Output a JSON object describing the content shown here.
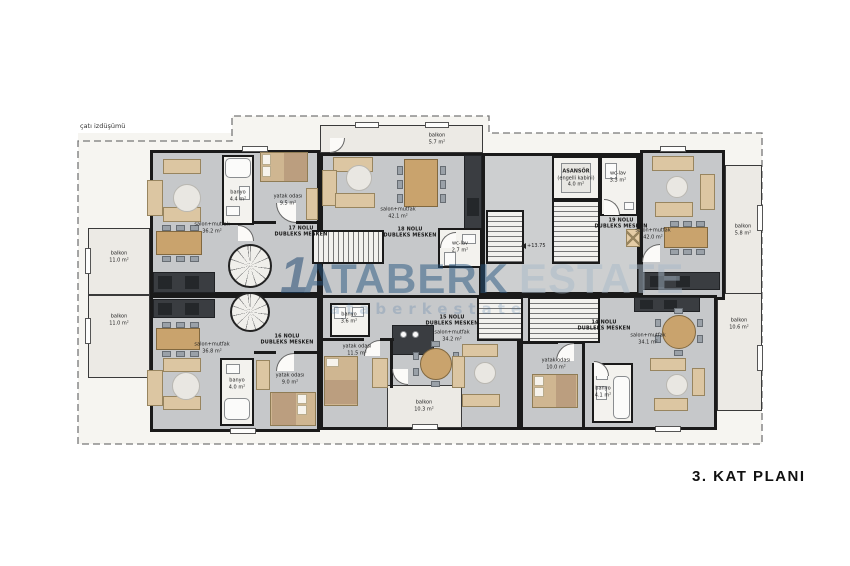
{
  "title": "3. KAT PLANI",
  "annotations": {
    "roof_projection": "çatı izdüşümü",
    "elevation": "+13.75"
  },
  "watermark": {
    "logo": "1",
    "brand": "ATABERK",
    "suffix": "ESTATE",
    "sub": "ataberkestate"
  },
  "colors": {
    "wall": "#1a1a1a",
    "floor": "#c6c8ca",
    "balcony": "#eceae5",
    "furniture_tan": "#dcc6a2",
    "wood": "#c9a36d",
    "counter_dark": "#3a3d41",
    "watermark_blue": "#26557f"
  },
  "core": {
    "elevator": {
      "name": "ASANSÖR",
      "detail": "(engelli kabini)",
      "area": "4.0 m²"
    }
  },
  "apartments": {
    "a17": {
      "no": "17 NOLU",
      "type": "DUBLEKS MESKEN",
      "rooms": {
        "salon": {
          "name": "salon+mutfak",
          "area": "36.2 m²"
        },
        "banyo": {
          "name": "banyo",
          "area": "4.4 m²"
        },
        "yatak": {
          "name": "yatak odası",
          "area": "9.5 m²"
        },
        "balkon": {
          "name": "balkon",
          "area": "11.0 m²"
        }
      }
    },
    "a18": {
      "no": "18 NOLU",
      "type": "DUBLEKS MESKEN",
      "rooms": {
        "salon": {
          "name": "salon+mutfak",
          "area": "42.1 m²"
        },
        "wc": {
          "name": "wc-lav",
          "area": "2.7 m²"
        },
        "balkon": {
          "name": "balkon",
          "area": "5.7 m²"
        }
      }
    },
    "a19": {
      "no": "19 NOLU",
      "type": "DUBLEKS MESKEN",
      "rooms": {
        "salon": {
          "name": "salon+mutfak",
          "area": "42.0 m²"
        },
        "wc": {
          "name": "wc-lav",
          "area": "3.3 m²"
        },
        "balkon": {
          "name": "balkon",
          "area": "5.8 m²"
        }
      }
    },
    "a16": {
      "no": "16 NOLU",
      "type": "DUBLEKS MESKEN",
      "rooms": {
        "salon": {
          "name": "salon+mutfak",
          "area": "36.8 m²"
        },
        "banyo": {
          "name": "banyo",
          "area": "4.0 m²"
        },
        "yatak": {
          "name": "yatak odası",
          "area": "9.0 m²"
        },
        "balkon": {
          "name": "balkon",
          "area": "11.0 m²"
        }
      }
    },
    "a15": {
      "no": "15 NOLU",
      "type": "DUBLEKS MESKEN",
      "rooms": {
        "salon": {
          "name": "salon+mutfak",
          "area": "34.2 m²"
        },
        "banyo": {
          "name": "banyo",
          "area": "3.6 m²"
        },
        "yatak": {
          "name": "yatak odası",
          "area": "11.5 m²"
        },
        "balkon": {
          "name": "balkon",
          "area": "10.3 m²"
        }
      }
    },
    "a14": {
      "no": "14 NOLU",
      "type": "DUBLEKS MESKEN",
      "rooms": {
        "salon": {
          "name": "salon+mutfak",
          "area": "34.1 m²"
        },
        "banyo": {
          "name": "banyo",
          "area": "4.1 m²"
        },
        "yatak": {
          "name": "yatak odası",
          "area": "10.0 m²"
        },
        "balkon": {
          "name": "balkon",
          "area": "10.6 m²"
        }
      }
    }
  }
}
